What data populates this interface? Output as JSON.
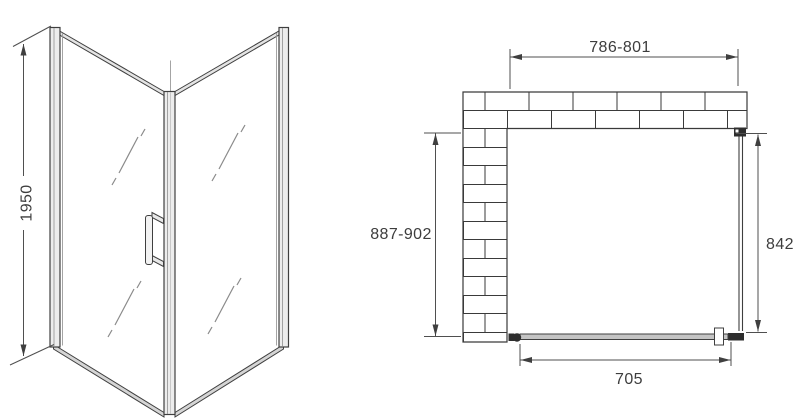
{
  "perspective_view": {
    "height_dimension": "1950"
  },
  "plan_view": {
    "top_width_dimension": "786-801",
    "left_depth_dimension": "887-902",
    "right_panel_dimension": "842",
    "door_opening_dimension": "705"
  },
  "colors": {
    "background": "#ffffff",
    "line": "#3f3f3f",
    "dimension_line": "#4f4f4f",
    "text": "#3d3d3d",
    "frame_fill": "#ededed",
    "bottom_rail_fill": "#d5d5d5",
    "door_fill": "#c4c4c4",
    "hardware": "#2e2e2e",
    "brick_mortar": "#3a3a3a"
  }
}
